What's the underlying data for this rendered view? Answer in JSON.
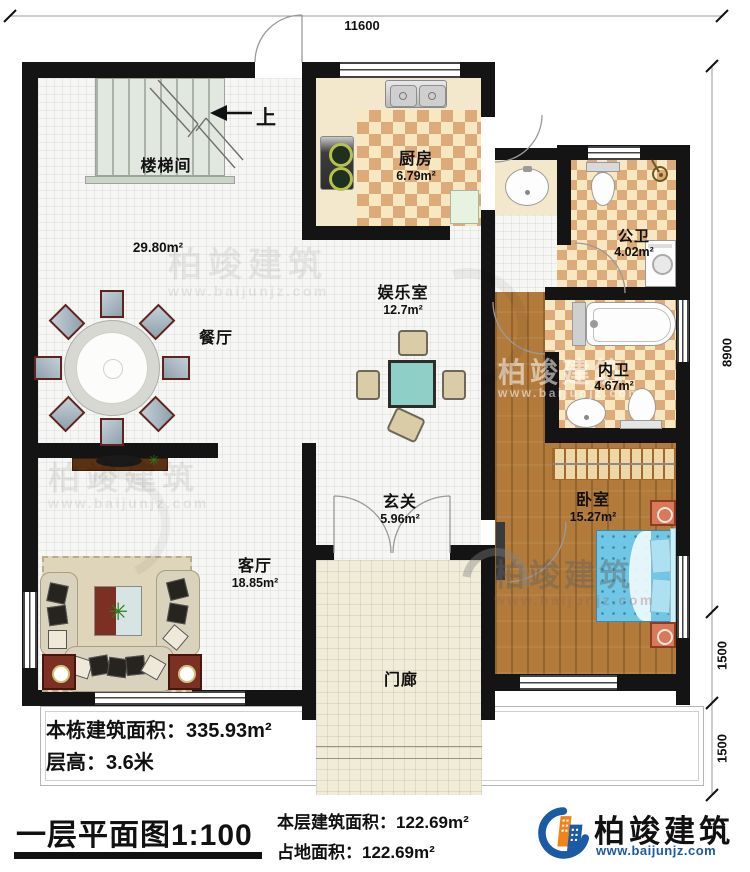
{
  "dimensions": {
    "top": "11600",
    "right_total": "8900",
    "right_mid": "1500",
    "right_bottom": "1500"
  },
  "rooms": {
    "stairwell": {
      "label": "楼梯间"
    },
    "hall": {
      "area": "29.80m²"
    },
    "dining": {
      "label": "餐厅"
    },
    "kitchen": {
      "label": "厨房",
      "area": "6.79m²"
    },
    "public_bath": {
      "label": "公卫",
      "area": "4.02m²"
    },
    "inner_bath": {
      "label": "内卫",
      "area": "4.67m²"
    },
    "entertainment": {
      "label": "娱乐室",
      "area": "12.7m²"
    },
    "foyer": {
      "label": "玄关",
      "area": "5.96m²"
    },
    "bedroom": {
      "label": "卧室",
      "area": "15.27m²"
    },
    "living": {
      "label": "客厅",
      "area": "18.85m²"
    },
    "porch": {
      "label": "门廊"
    }
  },
  "stairs": {
    "direction": "上"
  },
  "annotation": {
    "line1_label": "本栋建筑面积：",
    "line1_value": "335.93m²",
    "line2_label": "层高：",
    "line2_value": "3.6米"
  },
  "footer": {
    "plan_title": "一层平面图1:100",
    "line1_label": "本层建筑面积：",
    "line1_value": "122.69m²",
    "line2_label": "占地面积：",
    "line2_value": "122.69m²"
  },
  "brand": {
    "name": "柏竣建筑",
    "website": "www.baijunjz.com"
  },
  "watermark": {
    "text": "柏竣建筑",
    "website": "www.baijunjz.com"
  },
  "colors": {
    "wall": "#141414",
    "checker_dark": "#dcab79",
    "checker_light": "#f8e8c2",
    "wood": "#b27b3b",
    "bed": "#6fc7e5",
    "brand_blue": "#1b5aa5",
    "brand_orange": "#f08419"
  }
}
